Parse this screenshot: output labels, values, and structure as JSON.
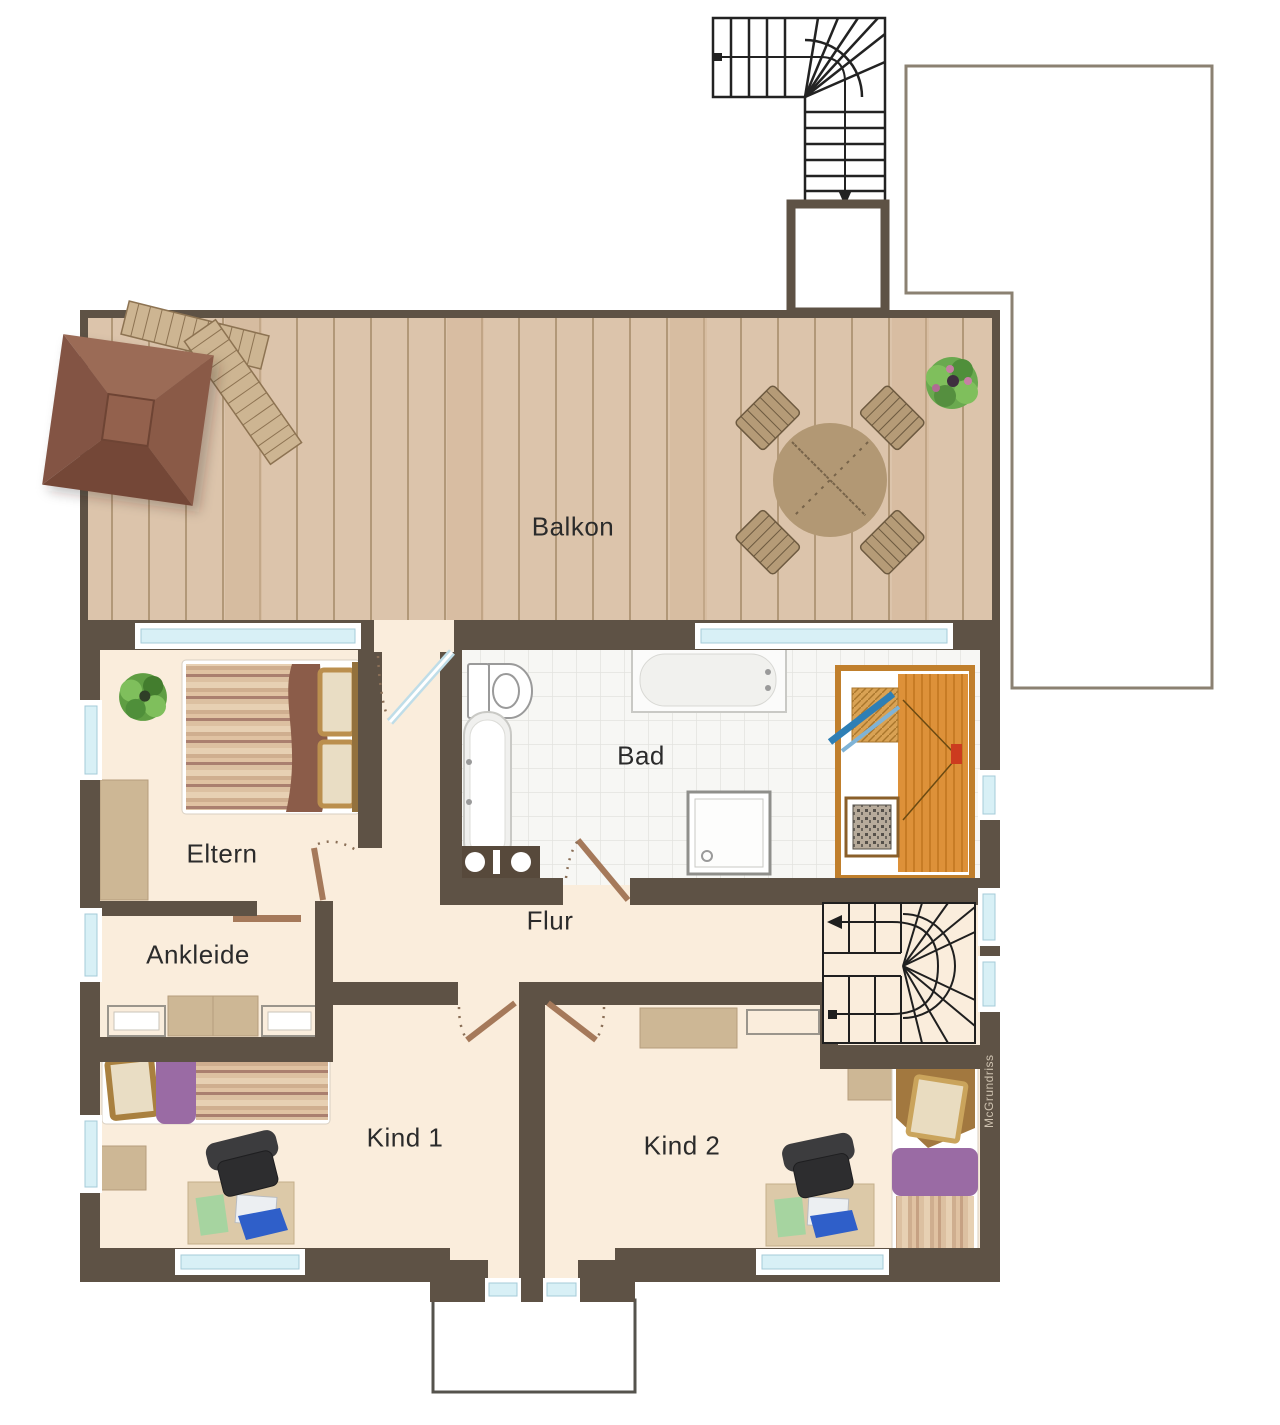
{
  "rooms": {
    "balcony": "Balkon",
    "parents": "Eltern",
    "dressing": "Ankleide",
    "bathroom": "Bad",
    "hallway": "Flur",
    "child1": "Kind 1",
    "child2": "Kind 2"
  },
  "watermark": "McGrundriss",
  "colors": {
    "wall": "#5E5245",
    "floor": "#FAEDDC",
    "deck": "#DCC4AB",
    "window_glass": "#D8F0F6",
    "bath_tile": "#F7F7F4",
    "sauna_wood": "#DD9139",
    "sauna_door_blue": "#2E7FB5",
    "accent_purple": "#9A6BA4",
    "blanket_brown": "#8B5C49",
    "outline_gray": "#8B8172",
    "door_wood": "#A5795A",
    "plan_lines": "#1F1F1F"
  }
}
